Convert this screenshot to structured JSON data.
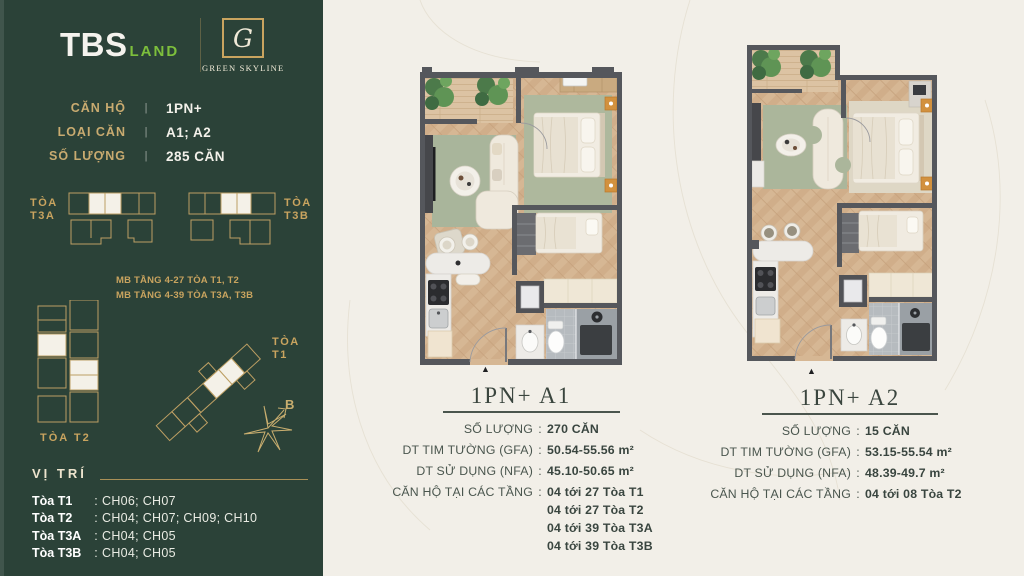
{
  "punct": {
    "colon": ":",
    "pipe": "|"
  },
  "colors": {
    "sidebar_green": "#2b4238",
    "gold": "#c9a45f",
    "accent_green": "#7dbf3c",
    "cream_background": "#f2efe8",
    "ink": "#3a453e",
    "wall_gray": "#55575c",
    "rug_green": "#a9b59b",
    "nightstand_orange": "#d2913e"
  },
  "sidebar": {
    "logo_tbs": "TBS",
    "logo_land": "LAND",
    "brand_monogram": "G",
    "brand_name": "GREEN SKYLINE",
    "specs": [
      {
        "label": "CĂN HỘ",
        "value": "1PN+"
      },
      {
        "label": "LOẠI CĂN",
        "value": "A1; A2"
      },
      {
        "label": "SỐ LƯỢNG",
        "value": "285 CĂN"
      }
    ],
    "tower_t3a": {
      "line1": "TÒA",
      "line2": "T3A"
    },
    "tower_t3b": {
      "line1": "TÒA",
      "line2": "T3B"
    },
    "mb_notes": [
      "MB TẦNG 4-27 TÒA T1, T2",
      "MB TẦNG 4-39 TÒA T3A, T3B"
    ],
    "tower_t2_label": "TÒA T2",
    "tower_t1": {
      "line1": "TÒA",
      "line2": "T1"
    },
    "compass_label": "B",
    "vitri_heading": "VỊ TRÍ",
    "vitri_rows": [
      {
        "tower": "Tòa T1",
        "units": "CH06; CH07"
      },
      {
        "tower": "Tòa T2",
        "units": "CH04; CH07; CH09; CH10"
      },
      {
        "tower": "Tòa T3A",
        "units": "CH04; CH05"
      },
      {
        "tower": "Tòa T3B",
        "units": "CH04; CH05"
      }
    ]
  },
  "plans": [
    {
      "title": "1PN+ A1",
      "entry_marker": "▲",
      "specs": [
        {
          "label": "SỐ LƯỢNG",
          "value": "270 CĂN"
        },
        {
          "label": "DT TIM TƯỜNG (GFA)",
          "value": "50.54-55.56 m²"
        },
        {
          "label": "DT SỬ DỤNG (NFA)",
          "value": "45.10-50.65 m²"
        },
        {
          "label": "CĂN HỘ TẠI CÁC TẦNG",
          "value": "04 tới 27 Tòa T1"
        }
      ],
      "extra": [
        "04 tới 27 Tòa T2",
        "04 tới 39 Tòa T3A",
        "04 tới 39 Tòa T3B"
      ]
    },
    {
      "title": "1PN+ A2",
      "entry_marker": "▲",
      "specs": [
        {
          "label": "SỐ LƯỢNG",
          "value": "15 CĂN"
        },
        {
          "label": "DT TIM TƯỜNG (GFA)",
          "value": "53.15-55.54 m²"
        },
        {
          "label": "DT SỬ DỤNG (NFA)",
          "value": "48.39-49.7 m²"
        },
        {
          "label": "CĂN HỘ TẠI CÁC TẦNG",
          "value": "04 tới 08 Tòa T2"
        }
      ]
    }
  ]
}
